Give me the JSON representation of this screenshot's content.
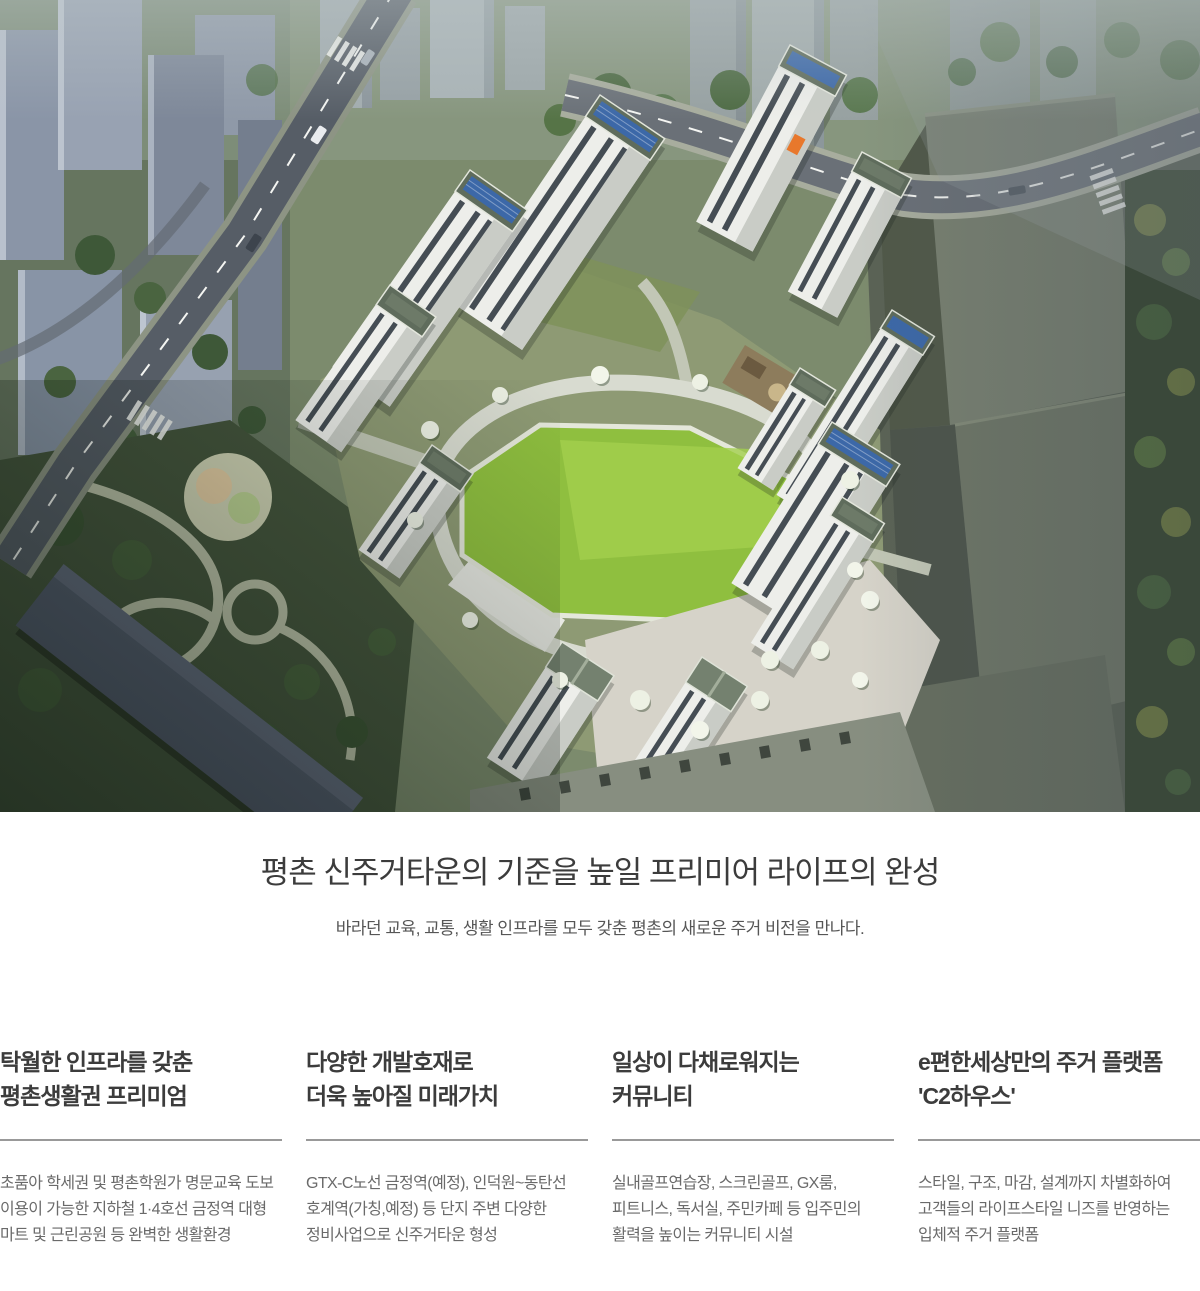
{
  "intro": {
    "title": "평촌 신주거타운의 기준을 높일 프리미어 라이프의 완성",
    "subtitle": "바라던 교육, 교통, 생활 인프라를 모두 갖춘 평촌의 새로운 주거 비전을 만나다."
  },
  "features": [
    {
      "title1": "탁월한 인프라를 갖춘",
      "title2": "평촌생활권 프리미엄",
      "body": "초품아 학세권 및 평촌학원가 명문교육 도보 이용이 가능한 지하철 1·4호선 금정역 대형 마트 및 근린공원 등 완벽한 생활환경"
    },
    {
      "title1": "다양한 개발호재로",
      "title2": "더욱 높아질 미래가치",
      "body": "GTX-C노선 금정역(예정), 인덕원~동탄선 호계역(가칭,예정) 등 단지 주변 다양한 정비사업으로 신주거타운 형성"
    },
    {
      "title1": "일상이 다채로워지는",
      "title2": "커뮤니티",
      "body": "실내골프연습장, 스크린골프, GX룸, 피트니스, 독서실, 주민카페 등 입주민의 활력을 높이는 커뮤니티 시설"
    },
    {
      "title1": "e편한세상만의 주거 플랫폼",
      "title2": "'C2하우스'",
      "body": "스타일, 구조, 마감, 설계까지 차별화하여 고객들의 라이프스타일 니즈를 반영하는 입체적 주거 플랫폼"
    }
  ],
  "colors": {
    "title_text": "#3c3c3c",
    "body_text": "#6a6a6a",
    "divider": "#999999",
    "hero_lawn": "#8fbf3f",
    "hero_solar_panel": "#3c68a8",
    "hero_brand_emblem": "#e8782c"
  }
}
